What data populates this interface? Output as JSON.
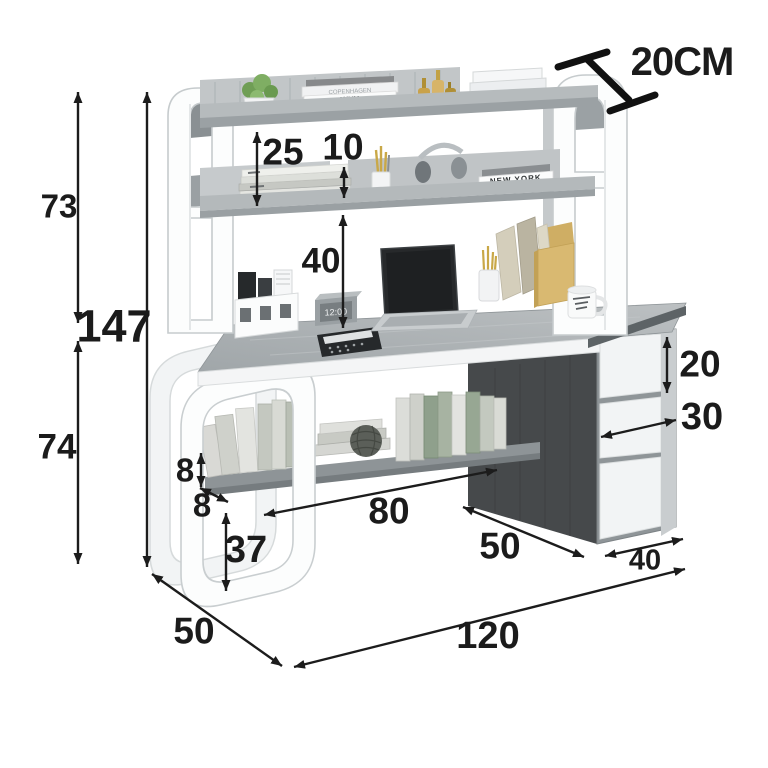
{
  "dimensions": {
    "hutch_height": "73",
    "total_height": "147",
    "desk_height": "74",
    "shelf_spacing": "25",
    "shelf_riser": "10",
    "hutch_clearance": "40",
    "shelf_depth_note": "20CM",
    "drawer_top": "20",
    "drawer_middle": "30",
    "shelf_lip_height": "8",
    "shelf_lip_depth": "8",
    "leg_clearance": "37",
    "open_width": "80",
    "frame_depth": "50",
    "cabinet_depth": "50",
    "cabinet_width": "40",
    "desk_width": "120"
  },
  "decor": {
    "clock_display": "12:00",
    "book_spines": {
      "top_shelf_1": "COPENHAGEN",
      "top_shelf_2": "WHY",
      "middle_shelf": "NEW YORK"
    }
  },
  "colors": {
    "frame_white": "#fcfdfd",
    "surface_gray": "#aeb4b7",
    "cabinet_dark": "#46494b",
    "drawer_white": "#f2f4f5",
    "dimension_black": "#1c1c1c",
    "accent_yellow": "#d9b971",
    "plant_green": "#7fae63"
  }
}
